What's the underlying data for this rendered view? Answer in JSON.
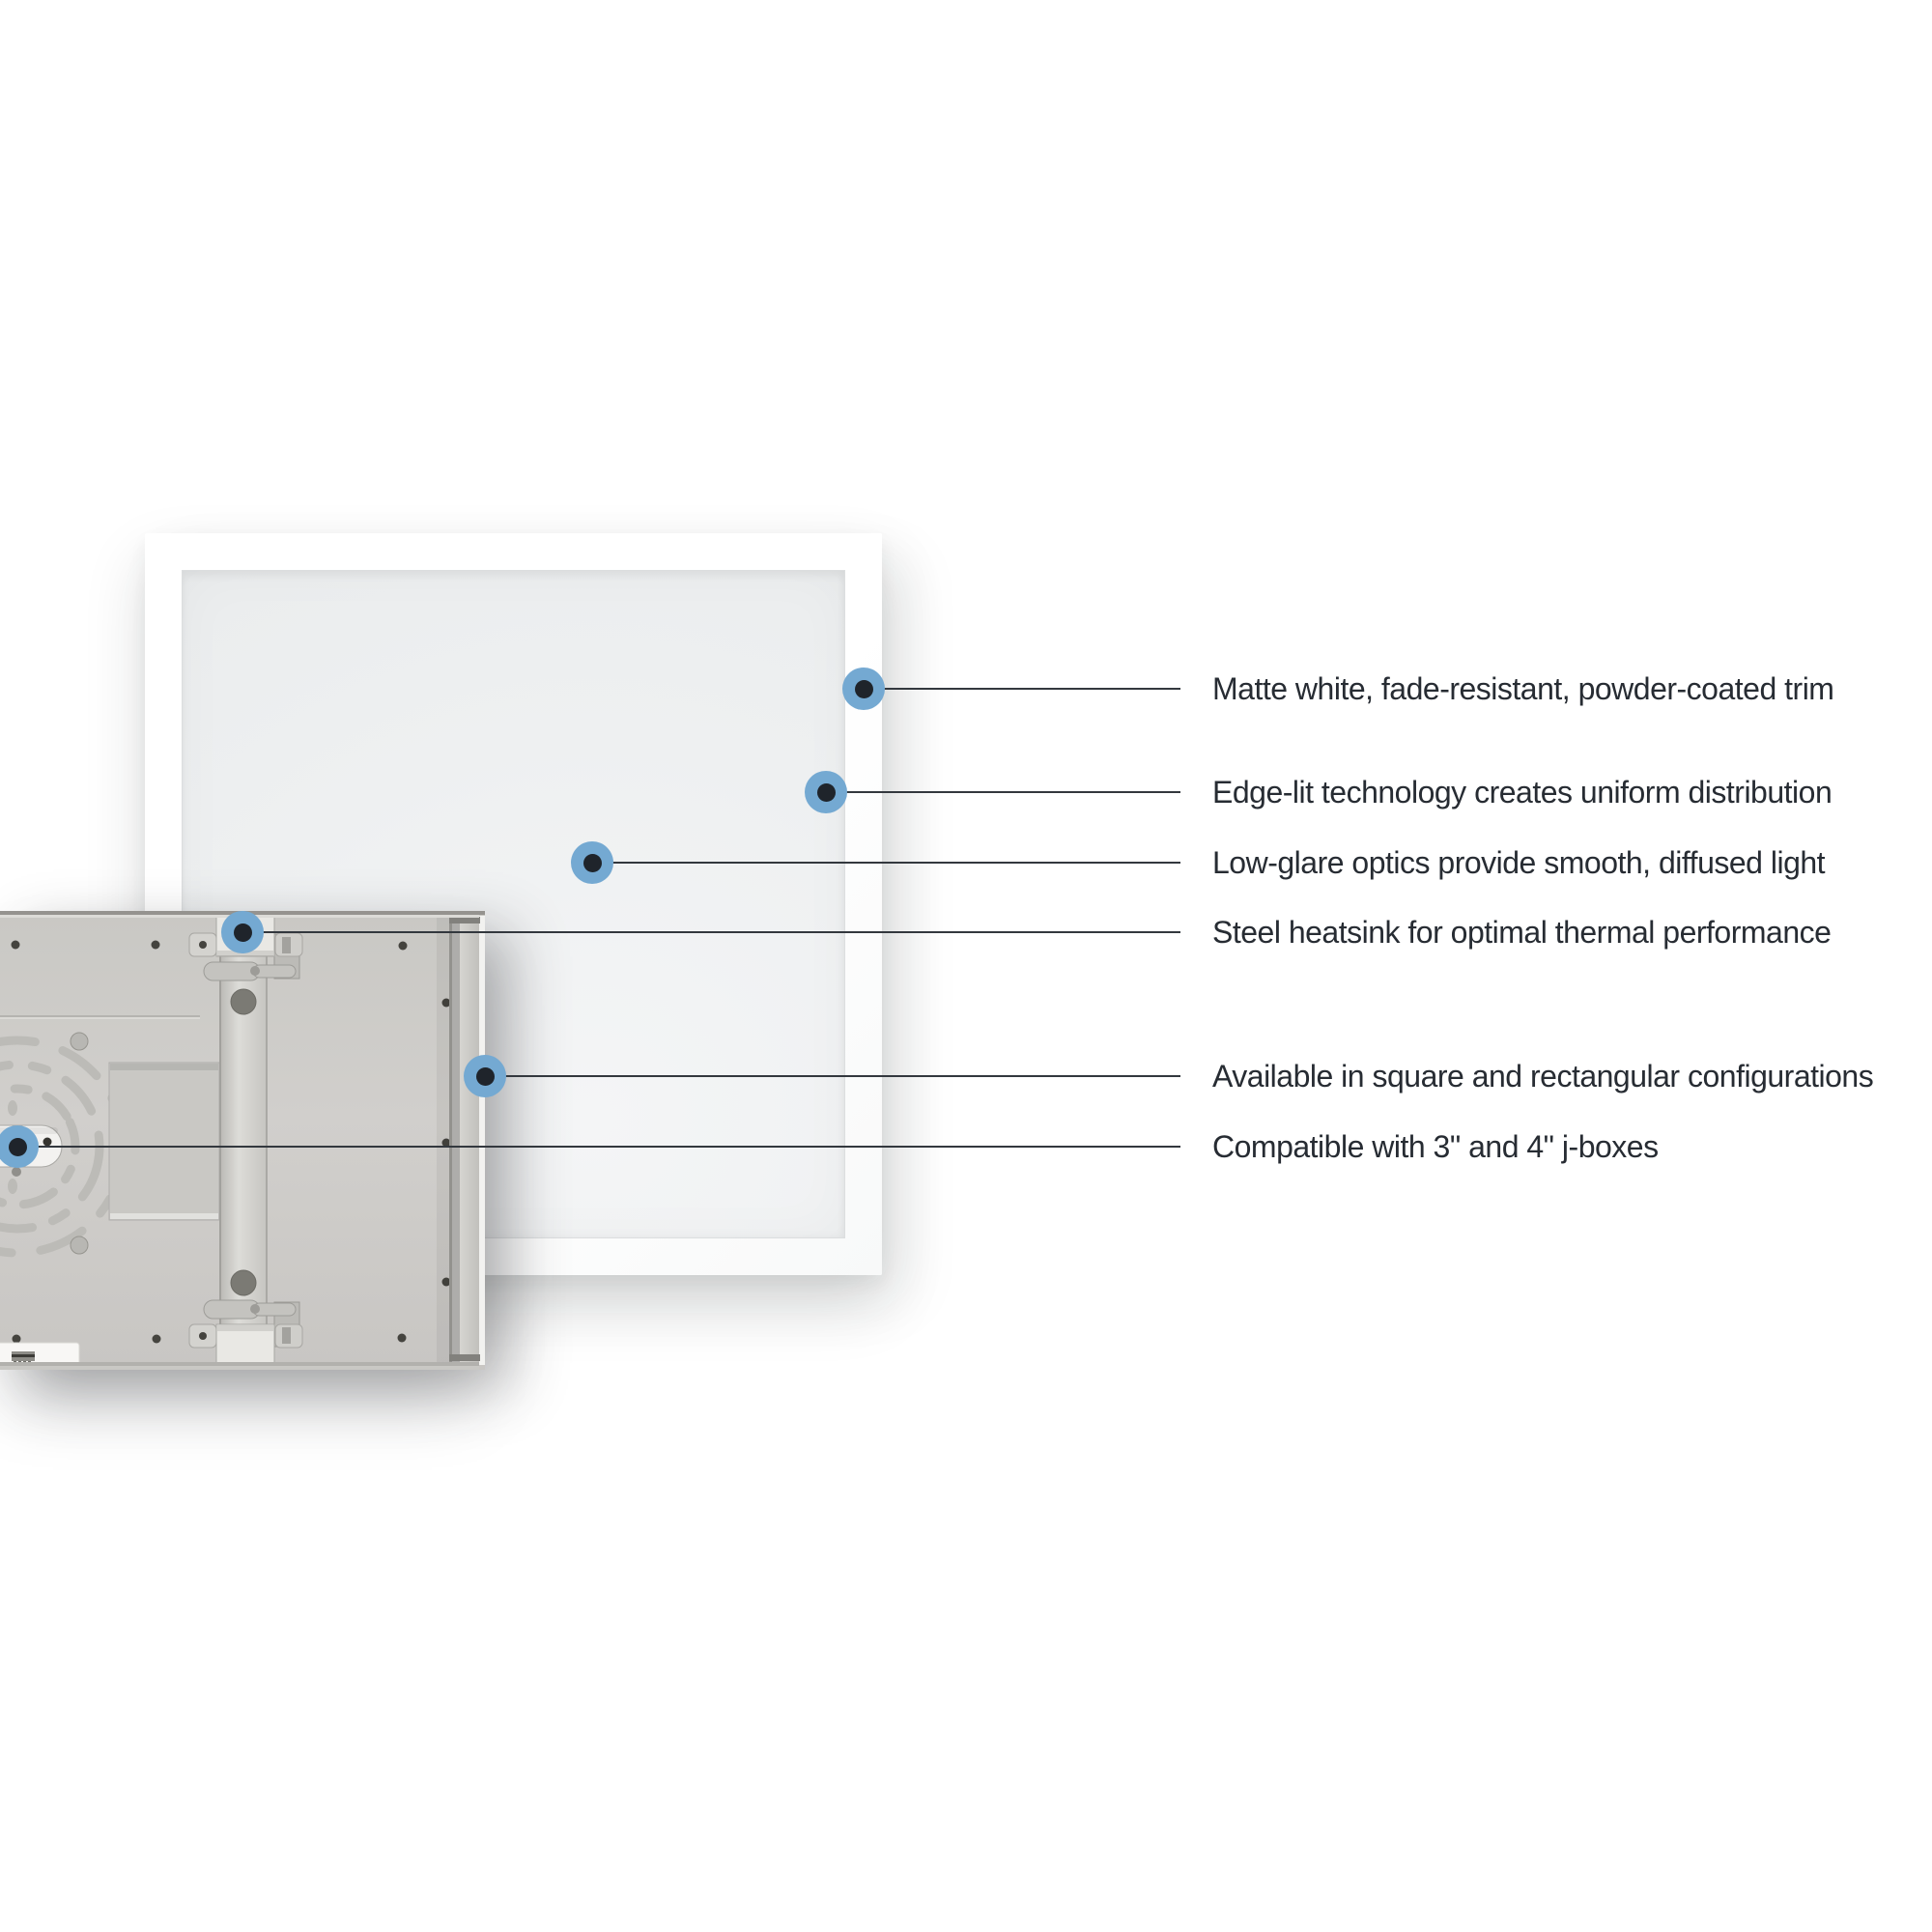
{
  "callouts": [
    {
      "label": "Matte white, fade-resistant, powder-coated trim"
    },
    {
      "label": "Edge-lit technology creates uniform distribution"
    },
    {
      "label": "Low-glare optics provide smooth, diffused light"
    },
    {
      "label": "Steel heatsink for optimal thermal performance"
    },
    {
      "label": "Available in square and rectangular configurations"
    },
    {
      "label": "Compatible with 3\" and 4\" j-boxes"
    }
  ],
  "colors": {
    "background": "#ffffff",
    "callout_dot_outer": "#74a9d2",
    "callout_dot_inner": "#1f242b",
    "callout_line": "#33383e",
    "label_text": "#272c33",
    "panel_trim_white": "#ffffff",
    "panel_diffuser_gray": "#eef0f1",
    "heatsink_steel_gray": "#cfcdc9"
  }
}
